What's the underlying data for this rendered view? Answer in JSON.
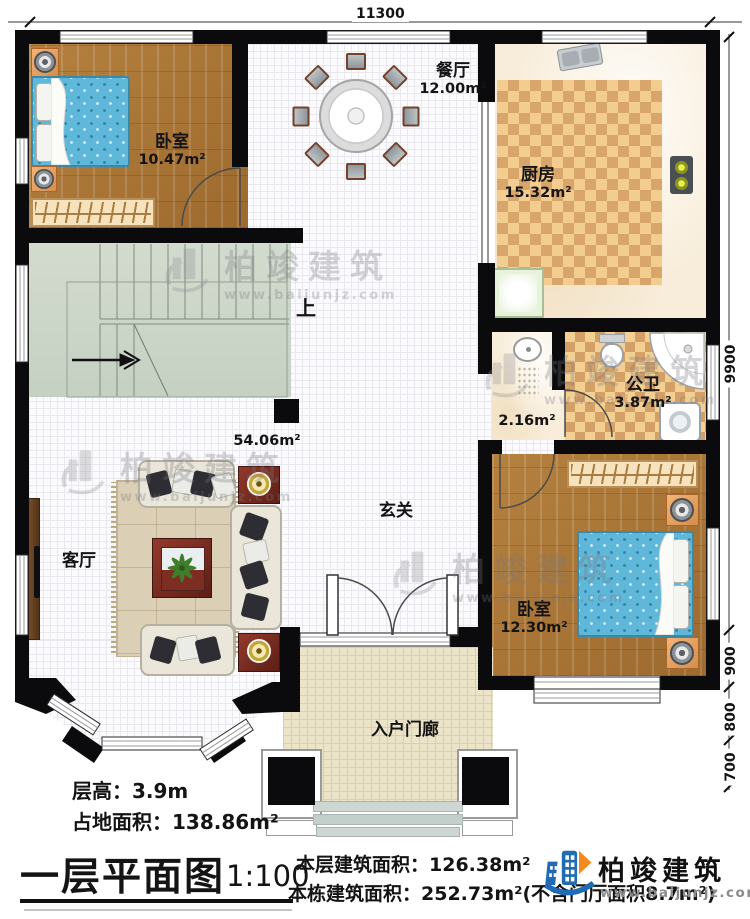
{
  "dimensions": {
    "top": "11300",
    "right": [
      "9900",
      "900",
      "800",
      "700"
    ]
  },
  "rooms": {
    "bedroom1": {
      "name": "卧室",
      "area": "10.47m²"
    },
    "dining": {
      "name": "餐厅",
      "area": "12.00m²"
    },
    "kitchen": {
      "name": "厨房",
      "area": "15.32m²"
    },
    "bathroom": {
      "name": "公卫",
      "area": "3.87m²"
    },
    "corridor": {
      "area": "2.16m²"
    },
    "foyer": {
      "name": "玄关",
      "area": "54.06m²"
    },
    "living": {
      "name": "客厅"
    },
    "bedroom2": {
      "name": "卧室",
      "area": "12.30m²"
    },
    "porch": {
      "name": "入户门廊"
    },
    "stairs": {
      "direction": "上"
    }
  },
  "footer": {
    "floor_height": "层高：3.9m",
    "land_area": "占地面积：138.86m²",
    "plan_title": "一层平面图",
    "scale": "1:100",
    "floor_area": "本层建筑面积：126.38m²",
    "total_area": "本栋建筑面积：252.73m²(不含门厅面积8.7m²)"
  },
  "brand": {
    "name": "柏竣建筑",
    "url": "www.baijunjz.com"
  }
}
